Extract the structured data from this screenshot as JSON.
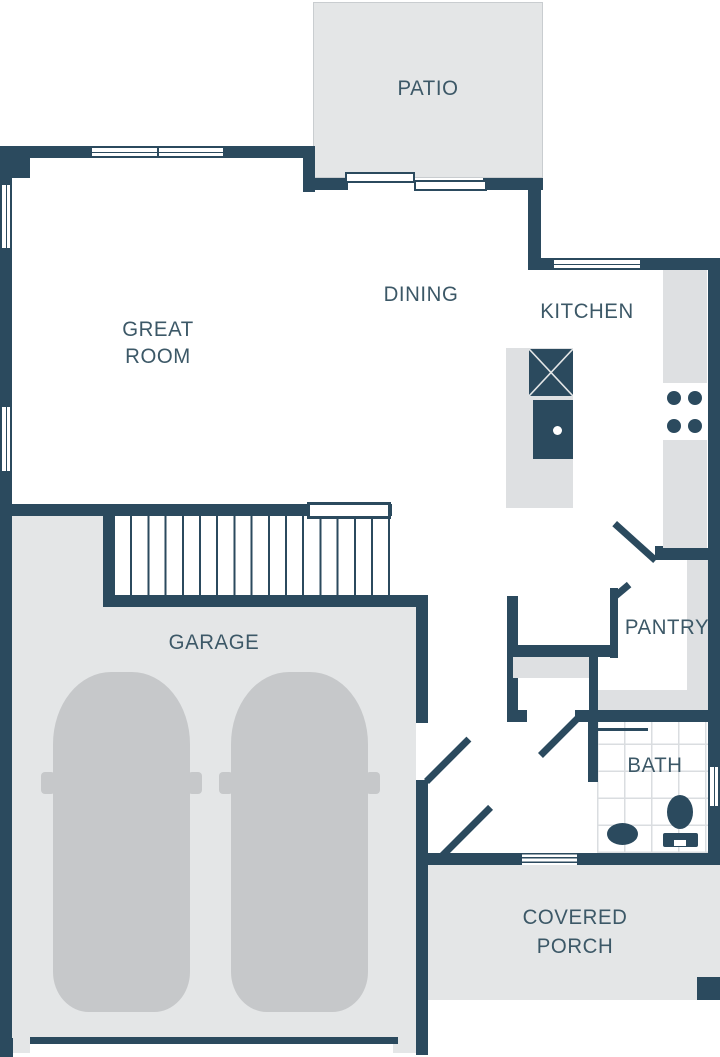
{
  "colors": {
    "wall": "#2b4a5e",
    "room_gray": "#e4e6e7",
    "fixture_gray": "#dee0e2",
    "car_gray": "#c6c8ca",
    "tile_line": "#dadde0",
    "text": "#3c5867",
    "patio_edge": "#c9cdd0"
  },
  "rooms": {
    "patio": {
      "label": "PATIO"
    },
    "great_room": {
      "line1": "GREAT",
      "line2": "ROOM"
    },
    "dining": {
      "label": "DINING"
    },
    "kitchen": {
      "label": "KITCHEN"
    },
    "garage": {
      "label": "GARAGE"
    },
    "pantry": {
      "label": "PANTRY"
    },
    "bath": {
      "label": "BATH"
    },
    "covered_porch": {
      "line1": "COVERED",
      "line2": "PORCH"
    }
  },
  "fixtures": {
    "island_appliance": "dishwasher-x-square",
    "island_sink": "sink-with-faucet-dot",
    "cooktop": "four-burner-cooktop",
    "toilet": "toilet",
    "bath_sink": "oval-sink",
    "cars": "two-parked-cars",
    "stairs": "staircase-up",
    "sliding_door": "patio-sliding-door",
    "front_entry": "stepped-threshold"
  }
}
